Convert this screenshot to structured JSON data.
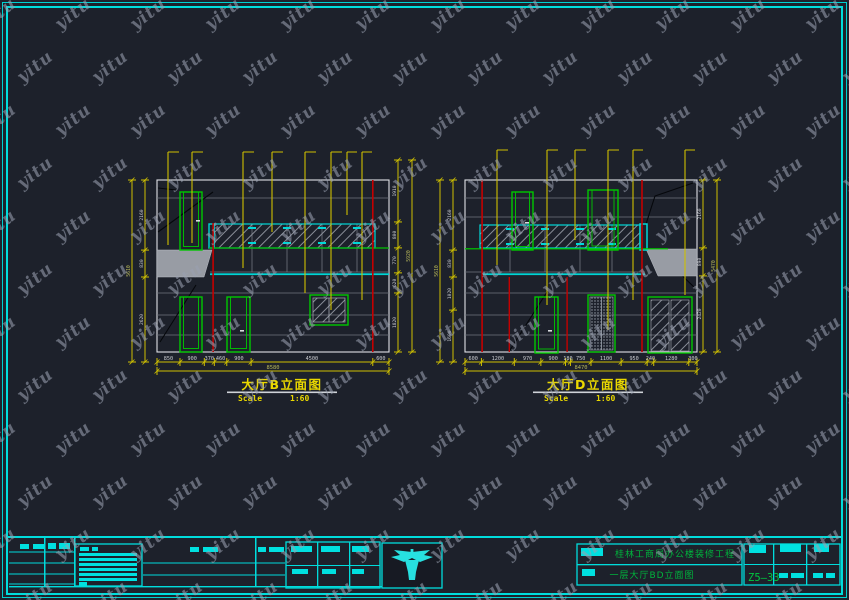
{
  "watermark": {
    "text": "yitu"
  },
  "colors": {
    "background": "#1d212b",
    "frame_cyan": "#00dcdc",
    "dimension_yellow": "#cfc000",
    "outline_green": "#00c800",
    "datum_red": "#c40000",
    "fill_gray": "#989ca4",
    "title_yellow": "#ead800",
    "titleblock_green": "#00b43c"
  },
  "drawings": {
    "left": {
      "title": "大厅B立面图",
      "scale_label": "Scale",
      "scale_value": "1:60",
      "bottom_dims": [
        "850",
        "900",
        "370",
        "460",
        "900",
        "4500",
        "600"
      ],
      "bottom_total": "8580",
      "left_dims": [
        "2160",
        "830",
        "2620"
      ],
      "left_total": "5610",
      "right_dims": [
        "1910",
        "800",
        "770",
        "620",
        "1820"
      ],
      "right_total": "5920"
    },
    "right": {
      "title": "大厅D立面图",
      "scale_label": "Scale",
      "scale_value": "1:60",
      "bottom_dims": [
        "600",
        "1200",
        "970",
        "900",
        "180",
        "750",
        "1100",
        "950",
        "240",
        "1280",
        "300"
      ],
      "bottom_total": "8470",
      "left_dims": [
        "2160",
        "830",
        "1020",
        "1600"
      ],
      "left_total": "5610",
      "right_dims": [
        "2160",
        "890",
        "2420"
      ],
      "right_total": "5470"
    }
  },
  "title_block": {
    "project_name": "桂林工商局办公楼装修工程",
    "sheet_name": "一层大厅BD立面图",
    "sheet_number": "Z5—33"
  }
}
